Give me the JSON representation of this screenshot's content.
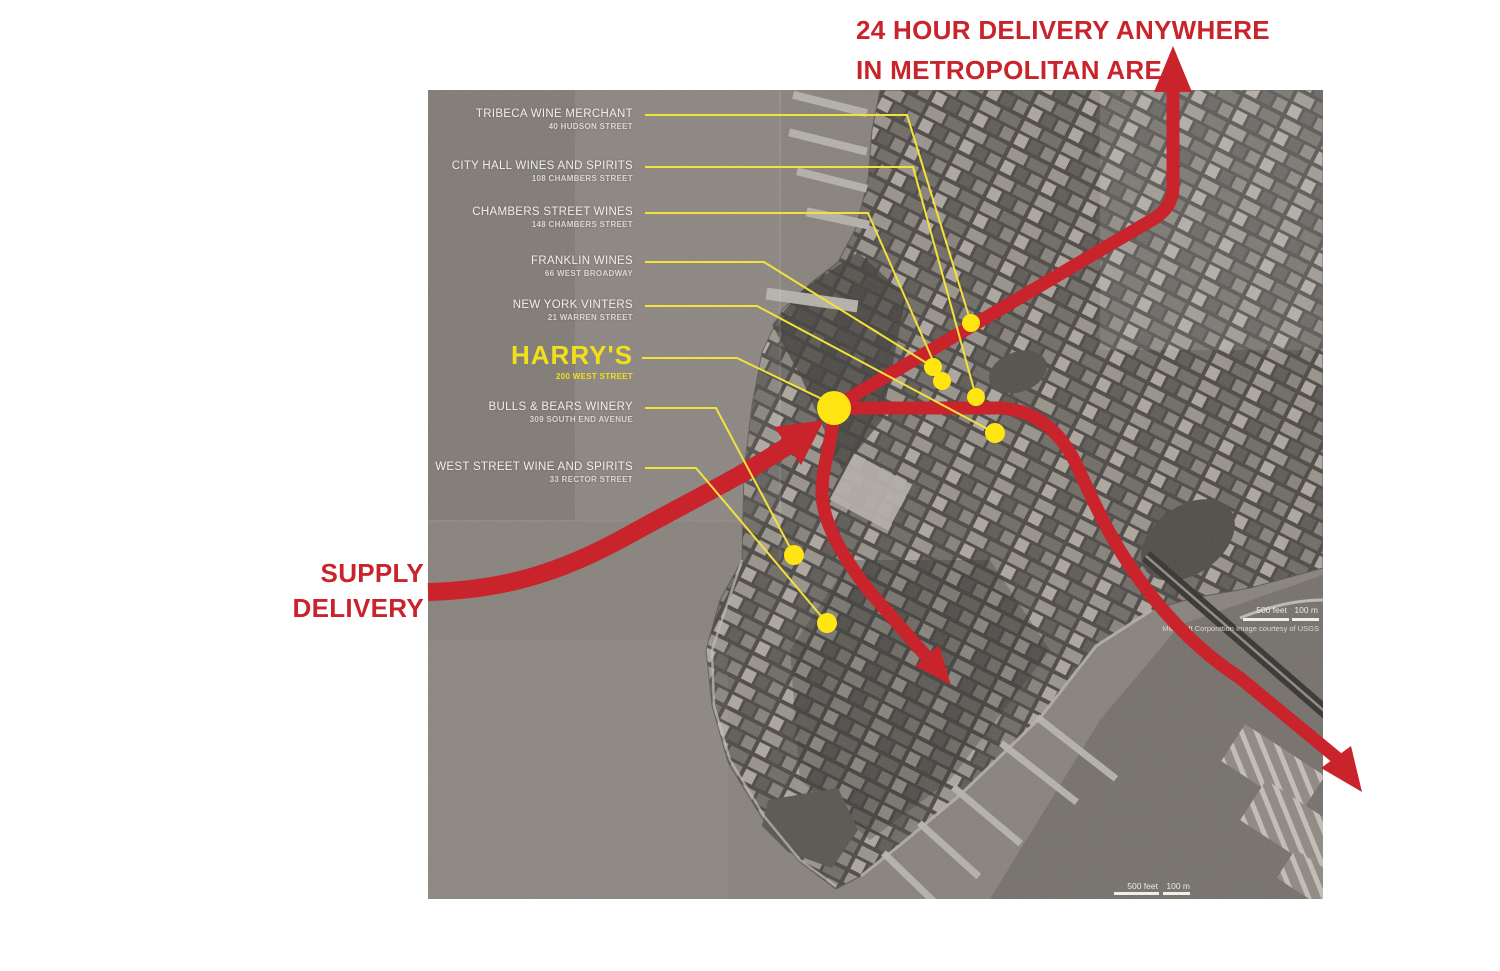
{
  "header": {
    "line1": "24 HOUR DELIVERY ANYWHERE",
    "line2": "IN METROPOLITAN AREA"
  },
  "supply": {
    "line1": "SUPPLY",
    "line2": "DELIVERY"
  },
  "locations": [
    {
      "name": "TRIBECA WINE MERCHANT",
      "address": "40 HUDSON STREET"
    },
    {
      "name": "CITY HALL WINES AND SPIRITS",
      "address": "108 CHAMBERS STREET"
    },
    {
      "name": "CHAMBERS STREET WINES",
      "address": "148 CHAMBERS STREET"
    },
    {
      "name": "FRANKLIN WINES",
      "address": "66 WEST BROADWAY"
    },
    {
      "name": "NEW YORK VINTERS",
      "address": "21 WARREN STREET"
    },
    {
      "name": "HARRY'S",
      "address": "200 WEST STREET",
      "featured": true
    },
    {
      "name": "BULLS & BEARS WINERY",
      "address": "309 SOUTH END AVENUE"
    },
    {
      "name": "WEST STREET WINE AND SPIRITS",
      "address": "33 RECTOR STREET"
    }
  ],
  "map": {
    "scale_mid": {
      "feet": "500 feet",
      "meters": "100 m"
    },
    "scale_bottom": {
      "feet": "500 feet",
      "meters": "100 m"
    },
    "attribution": "Microsoft Corporation   Image courtesy of USGS"
  },
  "colors": {
    "accent_red": "#c9232b",
    "highlight_yellow": "#ffe612",
    "water_gray": "#87817b"
  }
}
